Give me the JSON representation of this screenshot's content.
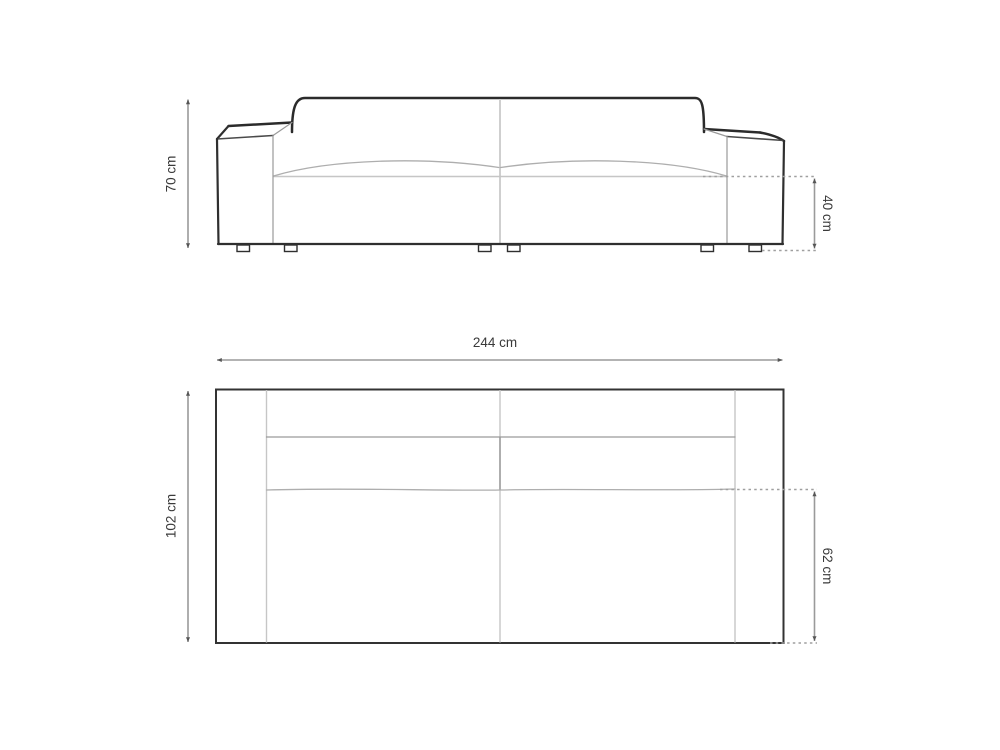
{
  "diagram": {
    "dimensions": [
      {
        "name": "overall_height",
        "label": "70 cm",
        "value": 70,
        "unit": "cm",
        "view": "front"
      },
      {
        "name": "seat_height",
        "label": "40 cm",
        "value": 40,
        "unit": "cm",
        "view": "front"
      },
      {
        "name": "overall_width",
        "label": "244 cm",
        "value": 244,
        "unit": "cm",
        "view": "top"
      },
      {
        "name": "overall_depth",
        "label": "102 cm",
        "value": 102,
        "unit": "cm",
        "view": "top"
      },
      {
        "name": "seat_depth",
        "label": "62 cm",
        "value": 62,
        "unit": "cm",
        "view": "top"
      }
    ],
    "colors": {
      "outline": "#2f2f2f",
      "detail_line": "#c6c6c6",
      "dimension_line": "#9a9a9a",
      "label_text": "#3a3a3a",
      "background": "#ffffff"
    }
  }
}
